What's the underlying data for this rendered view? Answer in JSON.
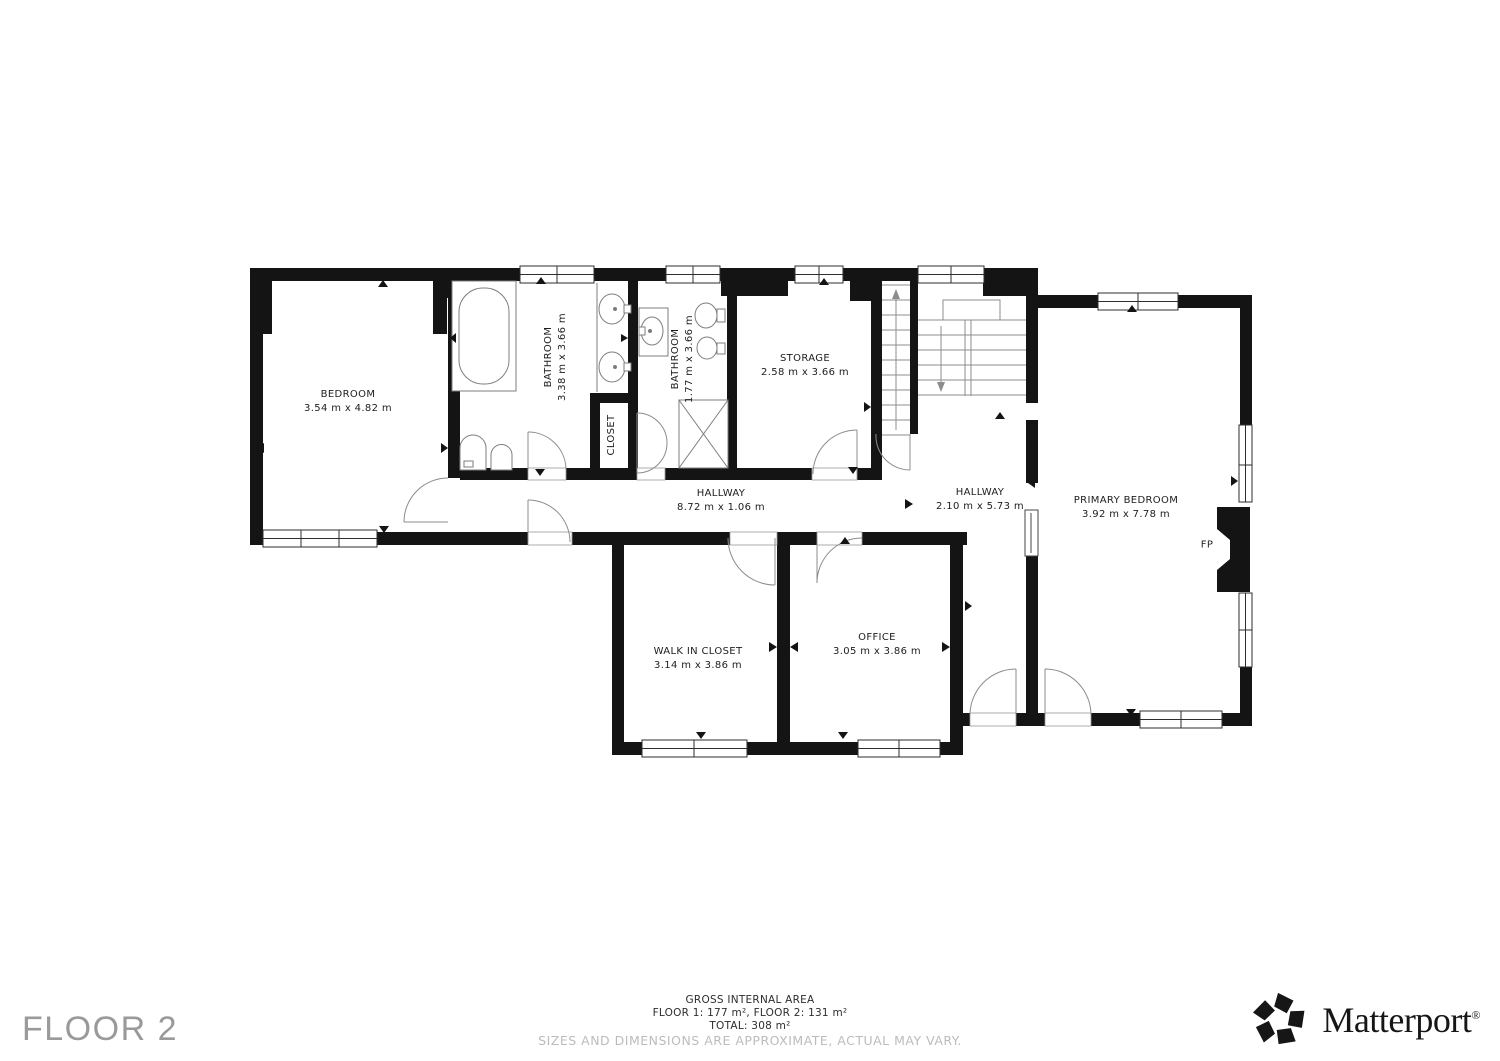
{
  "plan": {
    "rooms": [
      {
        "id": "bedroom",
        "name": "BEDROOM",
        "dims": "3.54 m x 4.82 m"
      },
      {
        "id": "bathroom-main",
        "name": "BATHROOM",
        "dims": "3.38 m x 3.66 m"
      },
      {
        "id": "closet",
        "name": "CLOSET",
        "dims": ""
      },
      {
        "id": "bathroom-small",
        "name": "BATHROOM",
        "dims": "1.77 m x 3.66 m"
      },
      {
        "id": "storage",
        "name": "STORAGE",
        "dims": "2.58 m x 3.66 m"
      },
      {
        "id": "hallway-main",
        "name": "HALLWAY",
        "dims": "8.72 m x 1.06 m"
      },
      {
        "id": "hallway-upper",
        "name": "HALLWAY",
        "dims": "2.10 m x 5.73 m"
      },
      {
        "id": "primary-bedroom",
        "name": "PRIMARY BEDROOM",
        "dims": "3.92 m x 7.78 m"
      },
      {
        "id": "walk-in-closet",
        "name": "WALK IN CLOSET",
        "dims": "3.14 m x 3.86 m"
      },
      {
        "id": "office",
        "name": "OFFICE",
        "dims": "3.05 m x 3.86 m"
      }
    ],
    "fireplace_label": "FP"
  },
  "footer": {
    "floor_label": "FLOOR 2",
    "summary_title": "GROSS INTERNAL AREA",
    "summary_line_1": "FLOOR 1: 177 m², FLOOR 2: 131 m²",
    "summary_line_2": "TOTAL: 308 m²",
    "disclaimer": "SIZES AND DIMENSIONS ARE APPROXIMATE, ACTUAL MAY VARY."
  },
  "brand": {
    "wordmark": "Matterport",
    "registered_mark": "®"
  },
  "colors": {
    "background": "#ffffff",
    "wall": "#141414",
    "fixture_line": "#7d7d7d",
    "door_line": "#8c8c8c",
    "label_text": "#1d1d1d",
    "disclaimer_text": "#bcbcbc",
    "floor_label_text": "#9a9a9a",
    "brand_text": "#161616"
  }
}
